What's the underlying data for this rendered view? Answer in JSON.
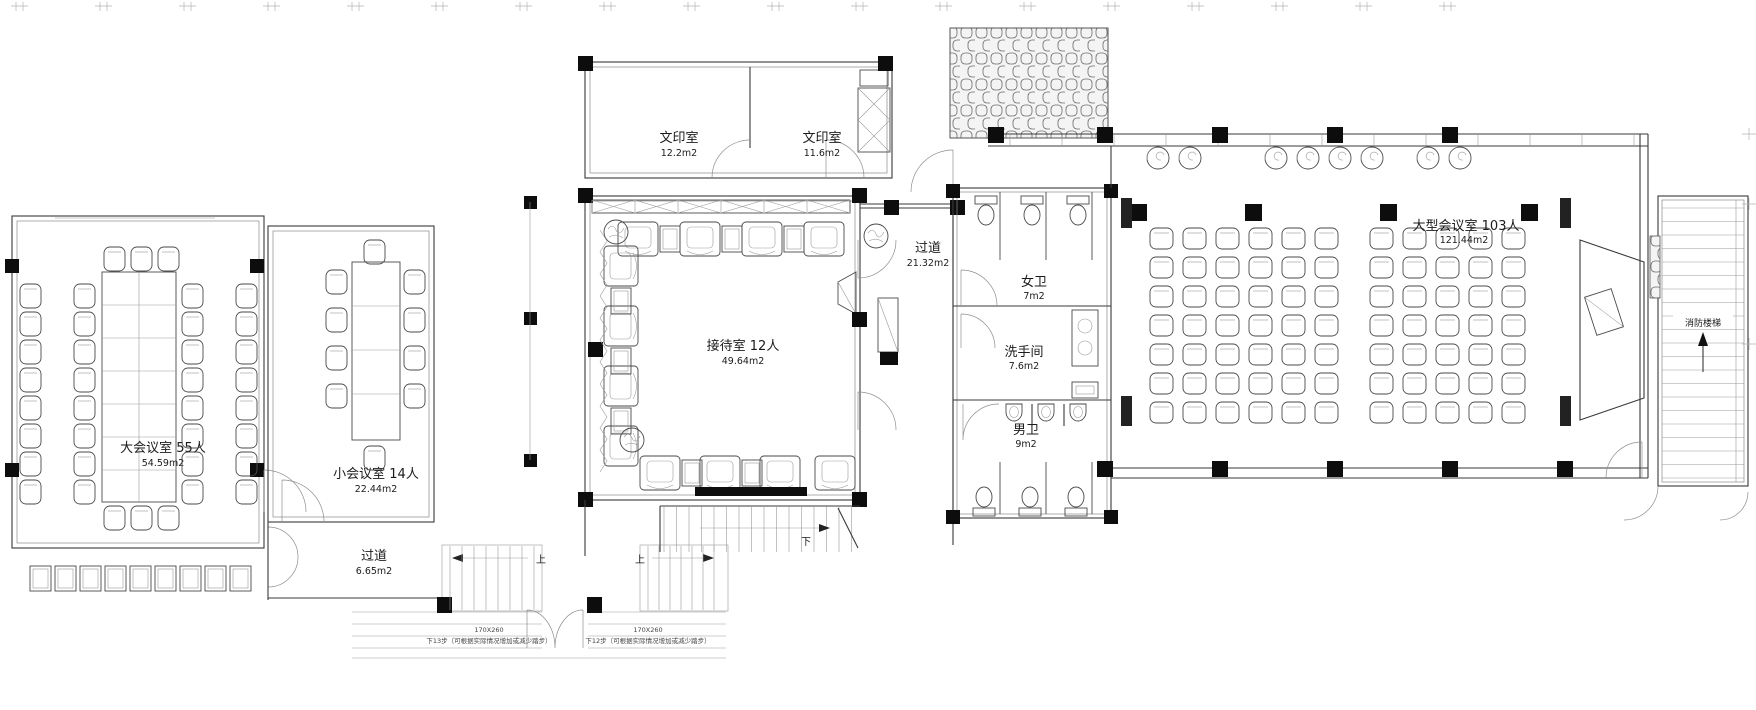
{
  "drawing": {
    "rooms": {
      "large_meeting": {
        "name": "大会议室  55人",
        "area": "54.59m2"
      },
      "small_meeting": {
        "name": "小会议室  14人",
        "area": "22.44m2"
      },
      "corridor_left": {
        "name": "过道",
        "area": "6.65m2"
      },
      "print_room_1": {
        "name": "文印室",
        "area": "12.2m2"
      },
      "print_room_2": {
        "name": "文印室",
        "area": "11.6m2"
      },
      "reception": {
        "name": "接待室  12人",
        "area": "49.64m2"
      },
      "corridor_mid": {
        "name": "过道",
        "area": "21.32m2"
      },
      "womens_toilet": {
        "name": "女卫",
        "area": "7m2"
      },
      "washroom": {
        "name": "洗手间",
        "area": "7.6m2"
      },
      "mens_toilet": {
        "name": "男卫",
        "area": "9m2"
      },
      "large_conference": {
        "name": "大型会议室  103人",
        "area": "121.44m2"
      },
      "fire_stairs": {
        "name": "消防楼梯"
      }
    },
    "stairs": {
      "up": "上",
      "down": "下",
      "tread_dim": "170X260",
      "note_13": "下13步（可根据实际情况增加或减少踏步）",
      "note_12": "下12步（可根据实际情况增加或减少踏步）"
    },
    "colors": {
      "line": "#3a3a3a",
      "light": "#9a9a9a",
      "solid": "#0d0d0d",
      "bg": "#ffffff"
    }
  }
}
